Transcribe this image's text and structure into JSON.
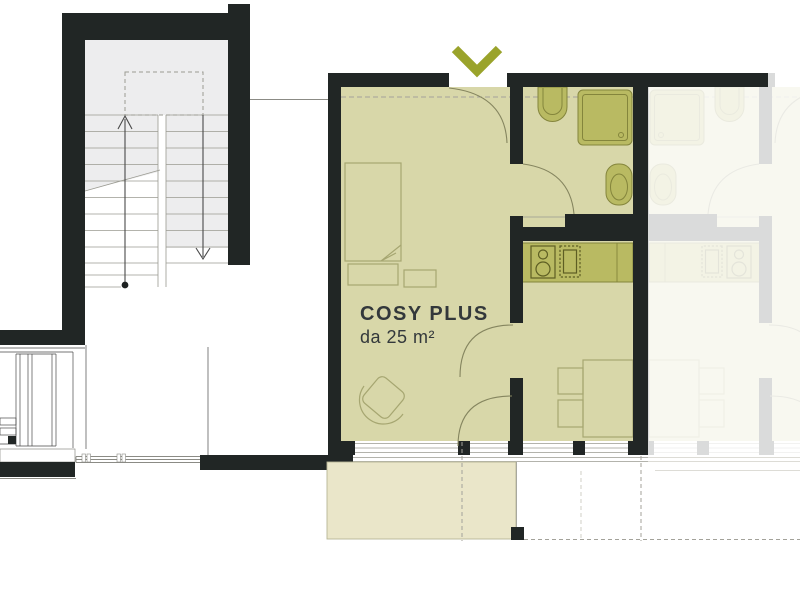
{
  "plan": {
    "unit": {
      "label": "COSY PLUS",
      "size": "da 25 m²"
    },
    "entrance_marker": {
      "icon": "chevron-down-icon",
      "color": "#9aa32b"
    },
    "faded_opacity": "0.16",
    "colors": {
      "wall": "#212625",
      "unit_fill": "#d8d7a9",
      "fixture_fill": "#b9ba62",
      "fixture_stroke": "#84853c",
      "furniture_stroke": "#a6a671",
      "balcony_fill": "#eae6c9",
      "stair_fill": "#ededee",
      "hairline": "#8b8b85",
      "dashed_line": "#a3a29a",
      "label_text": "#33383b",
      "background": "#ffffff"
    }
  }
}
